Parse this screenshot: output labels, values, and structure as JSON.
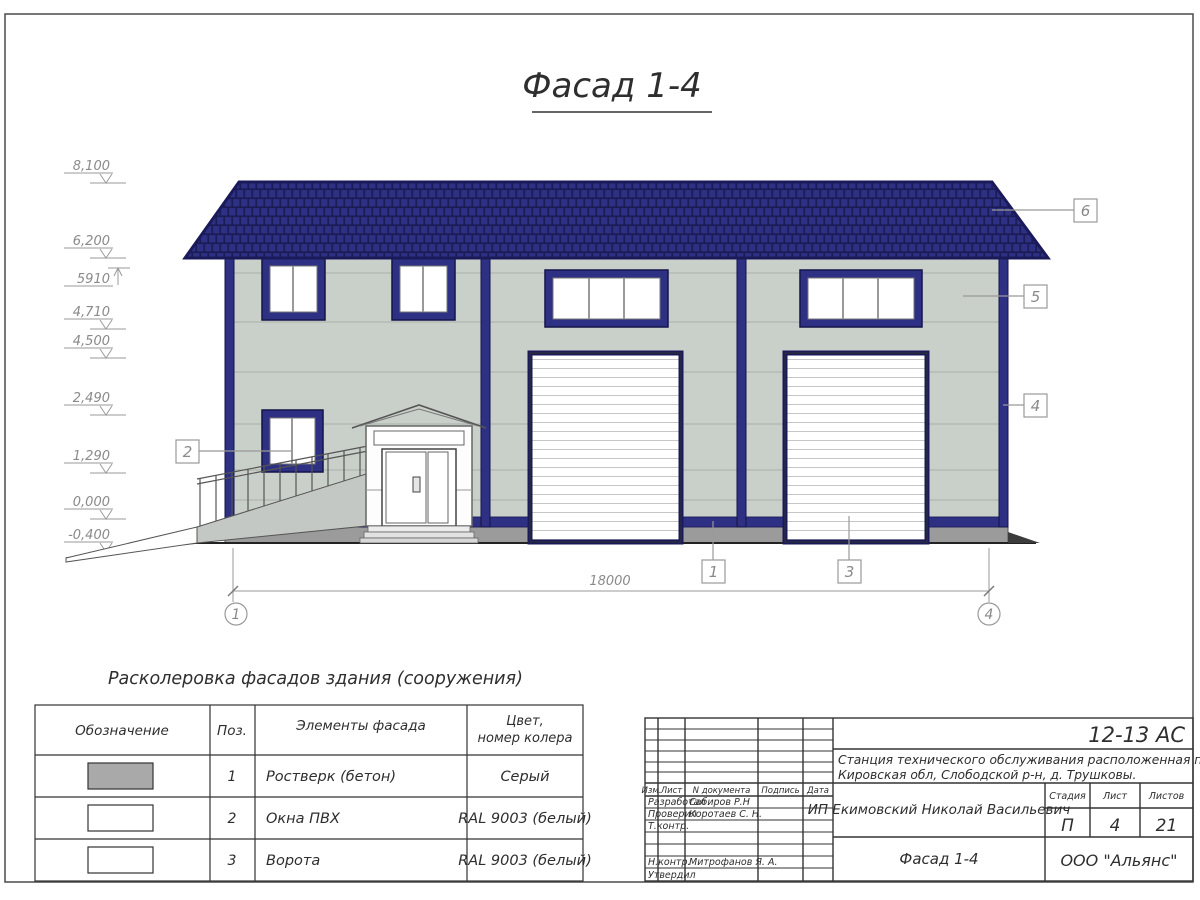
{
  "page": {
    "title": "Фасад 1-4"
  },
  "colors": {
    "accent_navy": "#2e3183",
    "navy_dark": "#1a1a5a",
    "wall_gray": "#c9cfc9",
    "plinth_gray": "#9b9b9b",
    "annotation_gray": "#8a8a8a"
  },
  "elevations": [
    {
      "value": "8,100"
    },
    {
      "value": "6,200"
    },
    {
      "value": "5910"
    },
    {
      "value": "4,710"
    },
    {
      "value": "4,500"
    },
    {
      "value": "2,490"
    },
    {
      "value": "1,290"
    },
    {
      "value": "0,000"
    },
    {
      "value": "-0,400"
    }
  ],
  "drawing": {
    "dimension_total": "18000",
    "axis_left": "1",
    "axis_right": "4",
    "callouts": [
      "1",
      "2",
      "3",
      "4",
      "5",
      "6"
    ]
  },
  "color_table": {
    "title": "Расколеровка фасадов здания (сооружения)",
    "headers": [
      "Обозначение",
      "Поз.",
      "Элементы фасада",
      {
        "line1": "Цвет,",
        "line2": "номер колера"
      }
    ],
    "rows": [
      {
        "swatch": "#a9a9a9",
        "pos": "1",
        "element": "Ростверк (бетон)",
        "color": "Серый"
      },
      {
        "swatch": "#ffffff",
        "pos": "2",
        "element": "Окна ПВХ",
        "color": "RAL 9003 (белый)"
      },
      {
        "swatch": "#ffffff",
        "pos": "3",
        "element": "Ворота",
        "color": "RAL 9003 (белый)"
      }
    ]
  },
  "title_block": {
    "doc_code": "12-13 АС",
    "object": {
      "line1": "Станция технического обслуживания расположенная по адресу",
      "line2": "Кировская обл, Слободской р-н, д. Трушковы."
    },
    "client": "ИП Екимовский Николай Васильевич",
    "sheet_title": "Фасад 1-4",
    "company": "ООО \"Альянс\"",
    "stage_label": "Стадия",
    "stage_value": "П",
    "sheet_label": "Лист",
    "sheet_value": "4",
    "sheets_label": "Листов",
    "sheets_value": "21",
    "rev_headers": [
      "Изм.",
      "Лист",
      "N документа",
      "Подпись",
      "Дата"
    ],
    "roles": [
      {
        "role": "Разработал",
        "name": "Сабиров Р.Н"
      },
      {
        "role": "Проверил",
        "name": "Коротаев С. Н."
      },
      {
        "role": "Т.контр.",
        "name": ""
      },
      {
        "role": "Н.контр.",
        "name": "Митрофанов Я. А."
      },
      {
        "role": "Утвердил",
        "name": ""
      }
    ]
  }
}
